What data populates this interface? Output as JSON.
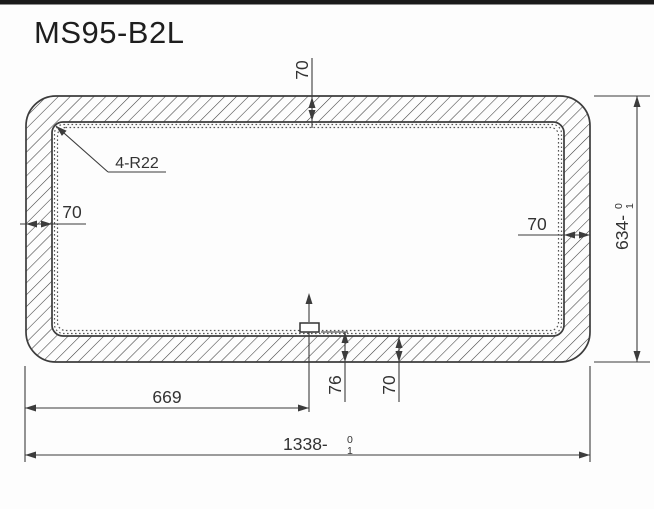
{
  "title": "MS95-B2L",
  "dims": {
    "top_wall": "70",
    "corner_note": "4-R22",
    "left_wall": "70",
    "right_wall": "70",
    "height": {
      "label": "634-",
      "tol_upper": "0",
      "tol_lower": "1"
    },
    "bottom_seam": "76",
    "bottom_wall": "70",
    "half_width": "669",
    "width": {
      "label": "1338-",
      "tol_upper": "0",
      "tol_lower": "1"
    }
  },
  "colors": {
    "background": "#fdfdfd",
    "top_bar": "#1a1a1a",
    "line": "#3c3c3c",
    "text": "#333333"
  }
}
